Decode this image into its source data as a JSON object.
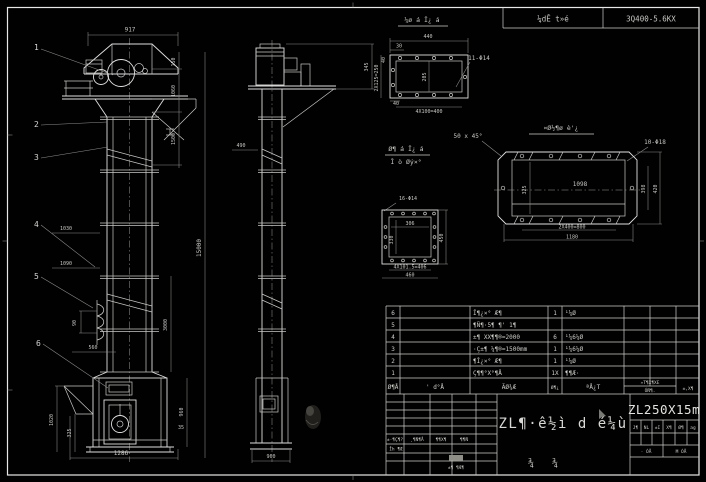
{
  "sheet": {
    "header": {
      "left_cell": "¼dÊ t»é",
      "right_cell": "3Q400-5.6KX"
    },
    "balloons": [
      "1",
      "2",
      "3",
      "4",
      "5",
      "6"
    ],
    "views": {
      "front": {
        "dims": {
          "width_top": "917",
          "h150": "150",
          "h1060": "1060",
          "h1500": "1500",
          "total": "15000",
          "pitch1": "1030",
          "pitch2": "1090",
          "bucket_h": "90",
          "bucket_w": "560",
          "boot_h1": "1020",
          "boot_h2": "325",
          "mid": "3000",
          "boot_right": "960",
          "base": "35",
          "boot_width": "1286"
        }
      },
      "side": {
        "dims": {
          "top_offset": "490",
          "bracket": "345",
          "base_width": "960"
        }
      }
    },
    "details": {
      "a": {
        "title": "¼ø á Î¿ á",
        "hole_label": "11-Φ14",
        "dims": {
          "w": "440",
          "d30": "30",
          "d40": "40",
          "left": "2X125=250",
          "inner": "205",
          "d40b": "40",
          "bottom": "4X100=400"
        }
      },
      "b": {
        "title": "¤Ø½¶ø è'¿",
        "note": "50 x 45°",
        "hole_label": "10-Φ18",
        "dims": {
          "inner_len": "1098",
          "inner_h": "325",
          "right1": "398",
          "right2": "420",
          "bottom1": "2X400=800",
          "bottom2": "1180"
        }
      },
      "c": {
        "title1": "Ø¶ á Î¿ á",
        "title2": "Î ò Øý×°",
        "hole_label": "16-Φ14",
        "dims": {
          "inner_w": "306",
          "inner_h": "330",
          "right": "450",
          "bottom1": "4X101.5=406",
          "bottom2": "460"
        }
      }
    },
    "bom": {
      "rows": [
        {
          "no": "6",
          "code": "",
          "name": "Î¶¿×° Æ¶",
          "qty": "1",
          "material": "¹¼Ø",
          "note": ""
        },
        {
          "no": "5",
          "code": "",
          "name": "¶Ñ¶·5¶ ¶' 1¶",
          "qty": "",
          "material": "",
          "note": ""
        },
        {
          "no": "4",
          "code": "",
          "name": "±¶ XX¶¶®=2000",
          "qty": "6",
          "material": "¹¼6¼Ø",
          "note": ""
        },
        {
          "no": "3",
          "code": "",
          "name": "·Ç±¶ ¼¶®=1500mm",
          "qty": "1",
          "material": "¹¼6¼Ø",
          "note": ""
        },
        {
          "no": "2",
          "code": "",
          "name": "¶Î¿×° Æ¶",
          "qty": "1",
          "material": "¹¼Ø",
          "note": ""
        },
        {
          "no": "1",
          "code": "",
          "name": "Ç¶¶°X°¶Å",
          "qty": "1X",
          "material": "¶¶Æ·",
          "note": ""
        }
      ],
      "header": {
        "no": "Ø¶Å",
        "code": "' d°Å",
        "name": "ÃØ¾Æ",
        "qty": "Ø¶¿",
        "material": "ªÅ¿T",
        "weight_top": "»T¶X¶XE",
        "weight_bottom": "ÓÑ¶.",
        "note": "±,X¶"
      }
    },
    "titleblock": {
      "drawing_title": "ZL¶·ê½ì d é¼ù",
      "model": "ZL250X15m",
      "left_headers": [
        "±·¶Ç¶?",
        "¸¶Ñ¶Å",
        "¶¶X¶",
        "¶¶Ñ"
      ],
      "left_row2": "Îh ¶Æ",
      "left_bottom": "±¶ ¶Æ¶",
      "right_headers": [
        "J¶",
        "NL",
        "±I",
        "X¶",
        "Ø¶",
        "ag"
      ],
      "scale_left": "· ÓÅ",
      "scale_right": "M ÓÅ",
      "middle_chars": [
        "¾",
        "¾"
      ]
    }
  }
}
